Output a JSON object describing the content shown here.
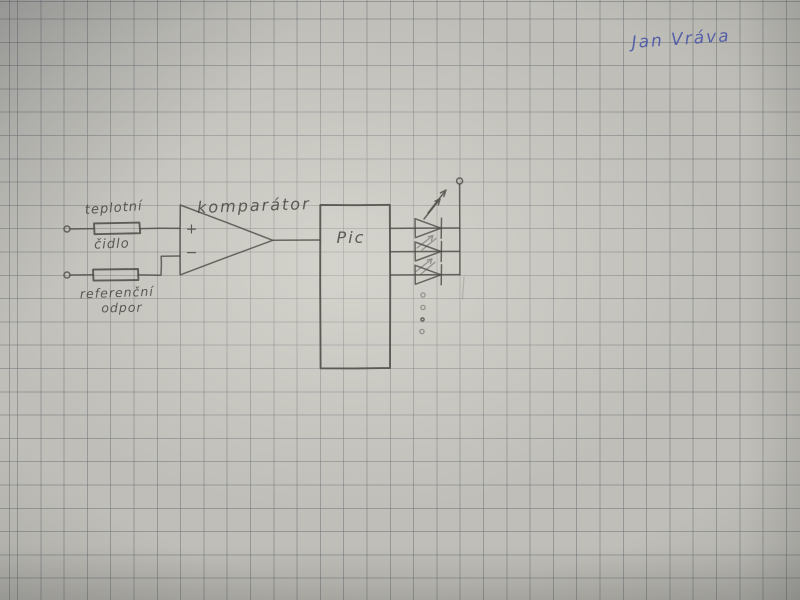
{
  "photo": {
    "description": "hand-drawn electronic schematic in pencil on squared graph paper",
    "paper_color": "#bfbeb8",
    "grid_color": "#6c7175",
    "pencil_color": "#4b4a45",
    "ink_color": "#4a57a6",
    "grid_spacing_px": 23.3
  },
  "signature": {
    "text": "Jan Vráva"
  },
  "schematic": {
    "labels": {
      "sensor_line1": "teplotní",
      "sensor_line2": "čidlo",
      "reference_line1": "referenční",
      "reference_line2": "odpor",
      "comparator": "komparátor",
      "mcu": "Pic",
      "plus": "+",
      "minus": "−"
    },
    "components": [
      {
        "name": "temperature-sensor-resistor",
        "symbol": "resistor box",
        "label": "teplotní čidlo"
      },
      {
        "name": "reference-resistor",
        "symbol": "resistor box",
        "label": "referenční odpor"
      },
      {
        "name": "comparator",
        "symbol": "op-amp triangle with + and − inputs",
        "label": "komparátor"
      },
      {
        "name": "microcontroller",
        "symbol": "rectangle block",
        "label": "Pic"
      },
      {
        "name": "led-array",
        "symbol": "LED diodes with emission arrows",
        "leds_drawn": 3,
        "ellipsis_dots": 4
      }
    ],
    "input_terminals": 2,
    "supply_terminals": 1
  }
}
